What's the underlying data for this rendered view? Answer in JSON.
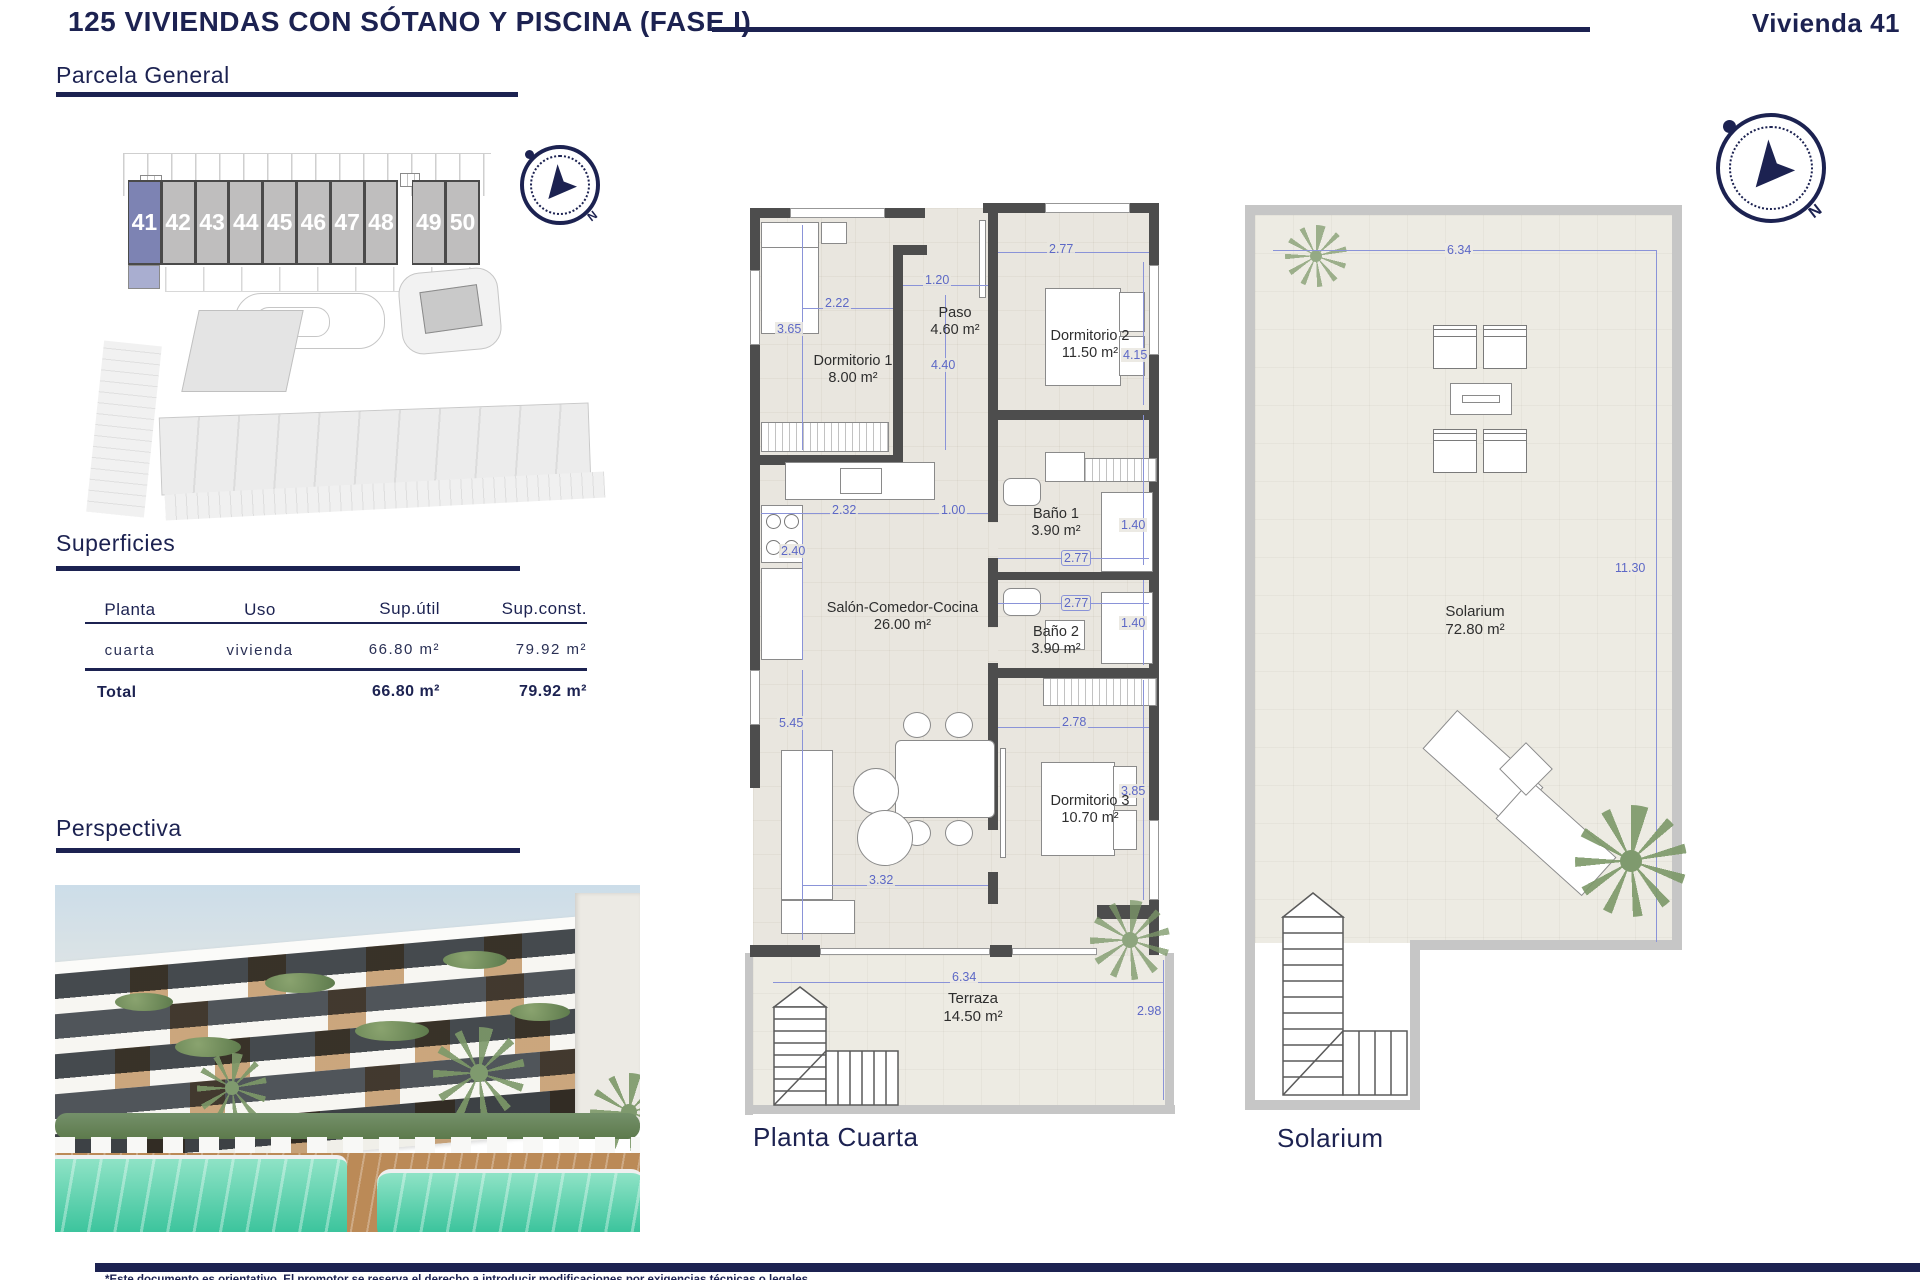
{
  "page": {
    "title": "125 VIVIENDAS CON SÓTANO Y PISCINA (FASE I)",
    "unit": "Vivienda 41",
    "footer_disclaimer": "*Este documento es orientativo. El promotor se reserva el derecho a introducir modificaciones por exigencias técnicas o legales."
  },
  "sections": {
    "parcela": {
      "heading": "Parcela General"
    },
    "superficies": {
      "heading": "Superficies"
    },
    "perspectiva": {
      "heading": "Perspectiva"
    }
  },
  "site_plan": {
    "units": [
      "41",
      "42",
      "43",
      "44",
      "45",
      "46",
      "47",
      "48",
      "49",
      "50"
    ],
    "highlighted_unit": "41",
    "gap_after": "48"
  },
  "surfaces_table": {
    "headers": [
      "Planta",
      "Uso",
      "Sup.útil",
      "Sup.const."
    ],
    "rows": [
      {
        "planta": "cuarta",
        "uso": "vivienda",
        "sup_util": "66.80 m²",
        "sup_const": "79.92 m²"
      }
    ],
    "total": {
      "label": "Total",
      "sup_util": "66.80 m²",
      "sup_const": "79.92 m²"
    }
  },
  "floor_plan": {
    "caption": "Planta Cuarta",
    "rooms": {
      "dormitorio1": {
        "name": "Dormitorio 1",
        "area": "8.00 m²"
      },
      "paso": {
        "name": "Paso",
        "area": "4.60 m²"
      },
      "dormitorio2": {
        "name": "Dormitorio 2",
        "area": "11.50 m²"
      },
      "salon": {
        "name": "Salón-Comedor-Cocina",
        "area": "26.00 m²"
      },
      "bano1": {
        "name": "Baño 1",
        "area": "3.90 m²"
      },
      "bano2": {
        "name": "Baño 2",
        "area": "3.90 m²"
      },
      "dormitorio3": {
        "name": "Dormitorio 3",
        "area": "10.70 m²"
      },
      "terraza": {
        "name": "Terraza",
        "area": "14.50 m²"
      }
    },
    "dims": {
      "dorm1_height": "3.65",
      "dorm1_width": "2.22",
      "paso_width": "1.20",
      "paso_height": "4.40",
      "dorm2_width": "2.77",
      "dorm2_height": "4.15",
      "cocina_width": "2.32",
      "cocina_pass": "1.00",
      "cocina_height": "2.40",
      "bano1_width": "2.77",
      "bano1_height": "1.40",
      "bano2_width": "2.77",
      "bano2_height": "1.40",
      "salon_height": "5.45",
      "salon_width": "3.32",
      "dorm3_width": "2.78",
      "dorm3_height": "3.85",
      "terraza_width": "6.34",
      "terraza_height": "2.98"
    }
  },
  "solarium_plan": {
    "caption": "Solarium",
    "room": {
      "name": "Solarium",
      "area": "72.80 m²"
    },
    "dims": {
      "width": "6.34",
      "height": "11.30"
    }
  },
  "compass": {
    "north_label": "N"
  },
  "colors": {
    "navy": "#1c2251",
    "dimension_blue": "#5d68c6",
    "wall_dark": "#4d4d4d",
    "wall_light": "#c6c6c6",
    "floor_beige": "#e9e6df",
    "unit_highlight": "#7d83b3",
    "unit_gray": "#bfbebe",
    "pool_green": "#3cc39b"
  }
}
